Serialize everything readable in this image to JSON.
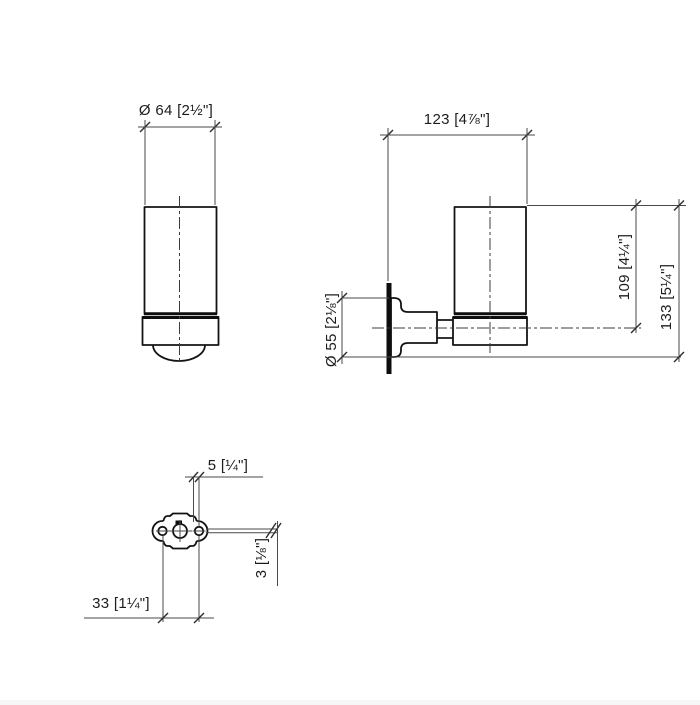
{
  "drawing": {
    "background": "#ffffff",
    "line_color": "#141414",
    "dim_line_color": "#4a4a4a",
    "text_color": "#1c1c1c",
    "views": {
      "front": {
        "dims": {
          "diameter": "Ø 64 [2½\"]"
        }
      },
      "side": {
        "dims": {
          "depth": "123 [4⅞\"]",
          "flange_diameter": "Ø 55 [2⅛\"]",
          "top_to_center": "109 [4¼\"]",
          "overall_height": "133 [5¼\"]"
        }
      },
      "mounting": {
        "dims": {
          "offset": "5 [¼\"]",
          "thickness": "3 [⅛\"]",
          "hole_spacing": "33 [1¼\"]"
        }
      }
    }
  }
}
